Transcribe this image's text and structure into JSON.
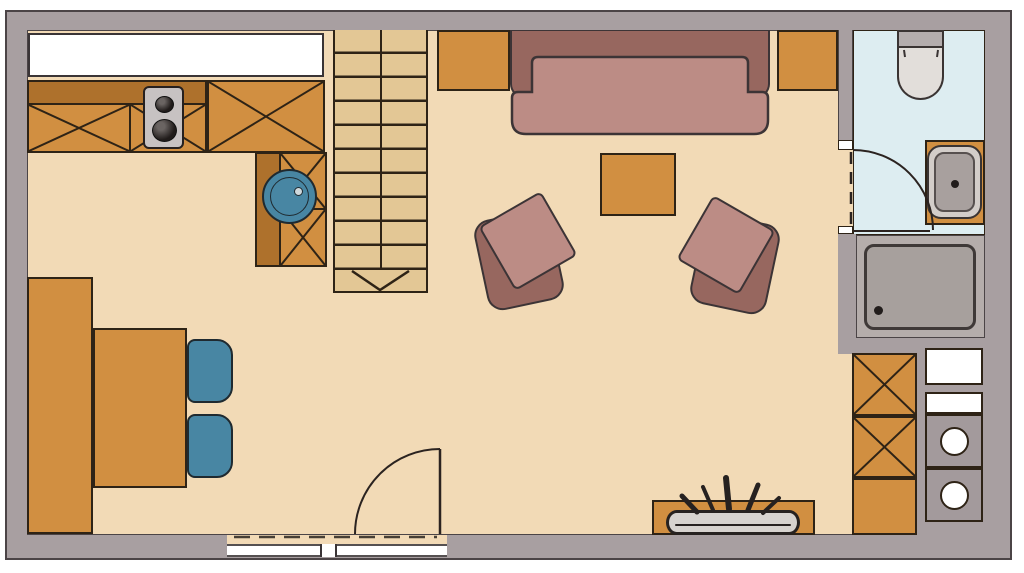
{
  "document": {
    "kind": "apartment floor plan drawing",
    "visible_text": "none"
  },
  "colors": {
    "wall": "#a89fa1",
    "wallLine": "#4b4446",
    "floor": "#f2dab6",
    "line": "#2e2316",
    "orange": "#d18f41",
    "orangeDark": "#ae712c",
    "stair": "#e3c795",
    "teal": "#4886a3",
    "sofaDark": "#97675f",
    "sofaLight": "#bc8c85",
    "bathFloor": "#ddedf1",
    "appliance": "#c7c2c2",
    "showerArea": "#b5adab",
    "showerPan": "#a7a09d",
    "rim": "#d3cdc9",
    "basin": "#a8a09e",
    "toiletTank": "#b4adad",
    "toiletBowl": "#e2deda",
    "planter": "#d7d3cf",
    "white": "#ffffff"
  },
  "plan": {
    "rooms": [
      "kitchen-dining",
      "living-area",
      "bathroom",
      "utility-corner"
    ],
    "kitchen_fixtures": [
      "worktop",
      "base-cabinets-x",
      "two-burner-stove",
      "round-sink"
    ],
    "dining_fixtures": [
      "wall-bench",
      "table",
      "chair",
      "chair"
    ],
    "living_fixtures": [
      "sofa",
      "armchair",
      "armchair",
      "coffee-table",
      "sideboard",
      "sideboard",
      "plant-trough"
    ],
    "bathroom_fixtures": [
      "toilet",
      "washbasin",
      "shower"
    ],
    "utility_fixtures": [
      "cabinets-x",
      "counter",
      "appliance-front-load",
      "appliance-front-load"
    ],
    "circulation": [
      "staircase-with-direction-arrow",
      "entry-door-swing",
      "bathroom-door-swing",
      "window-band-bottom",
      "window-top-left"
    ]
  }
}
